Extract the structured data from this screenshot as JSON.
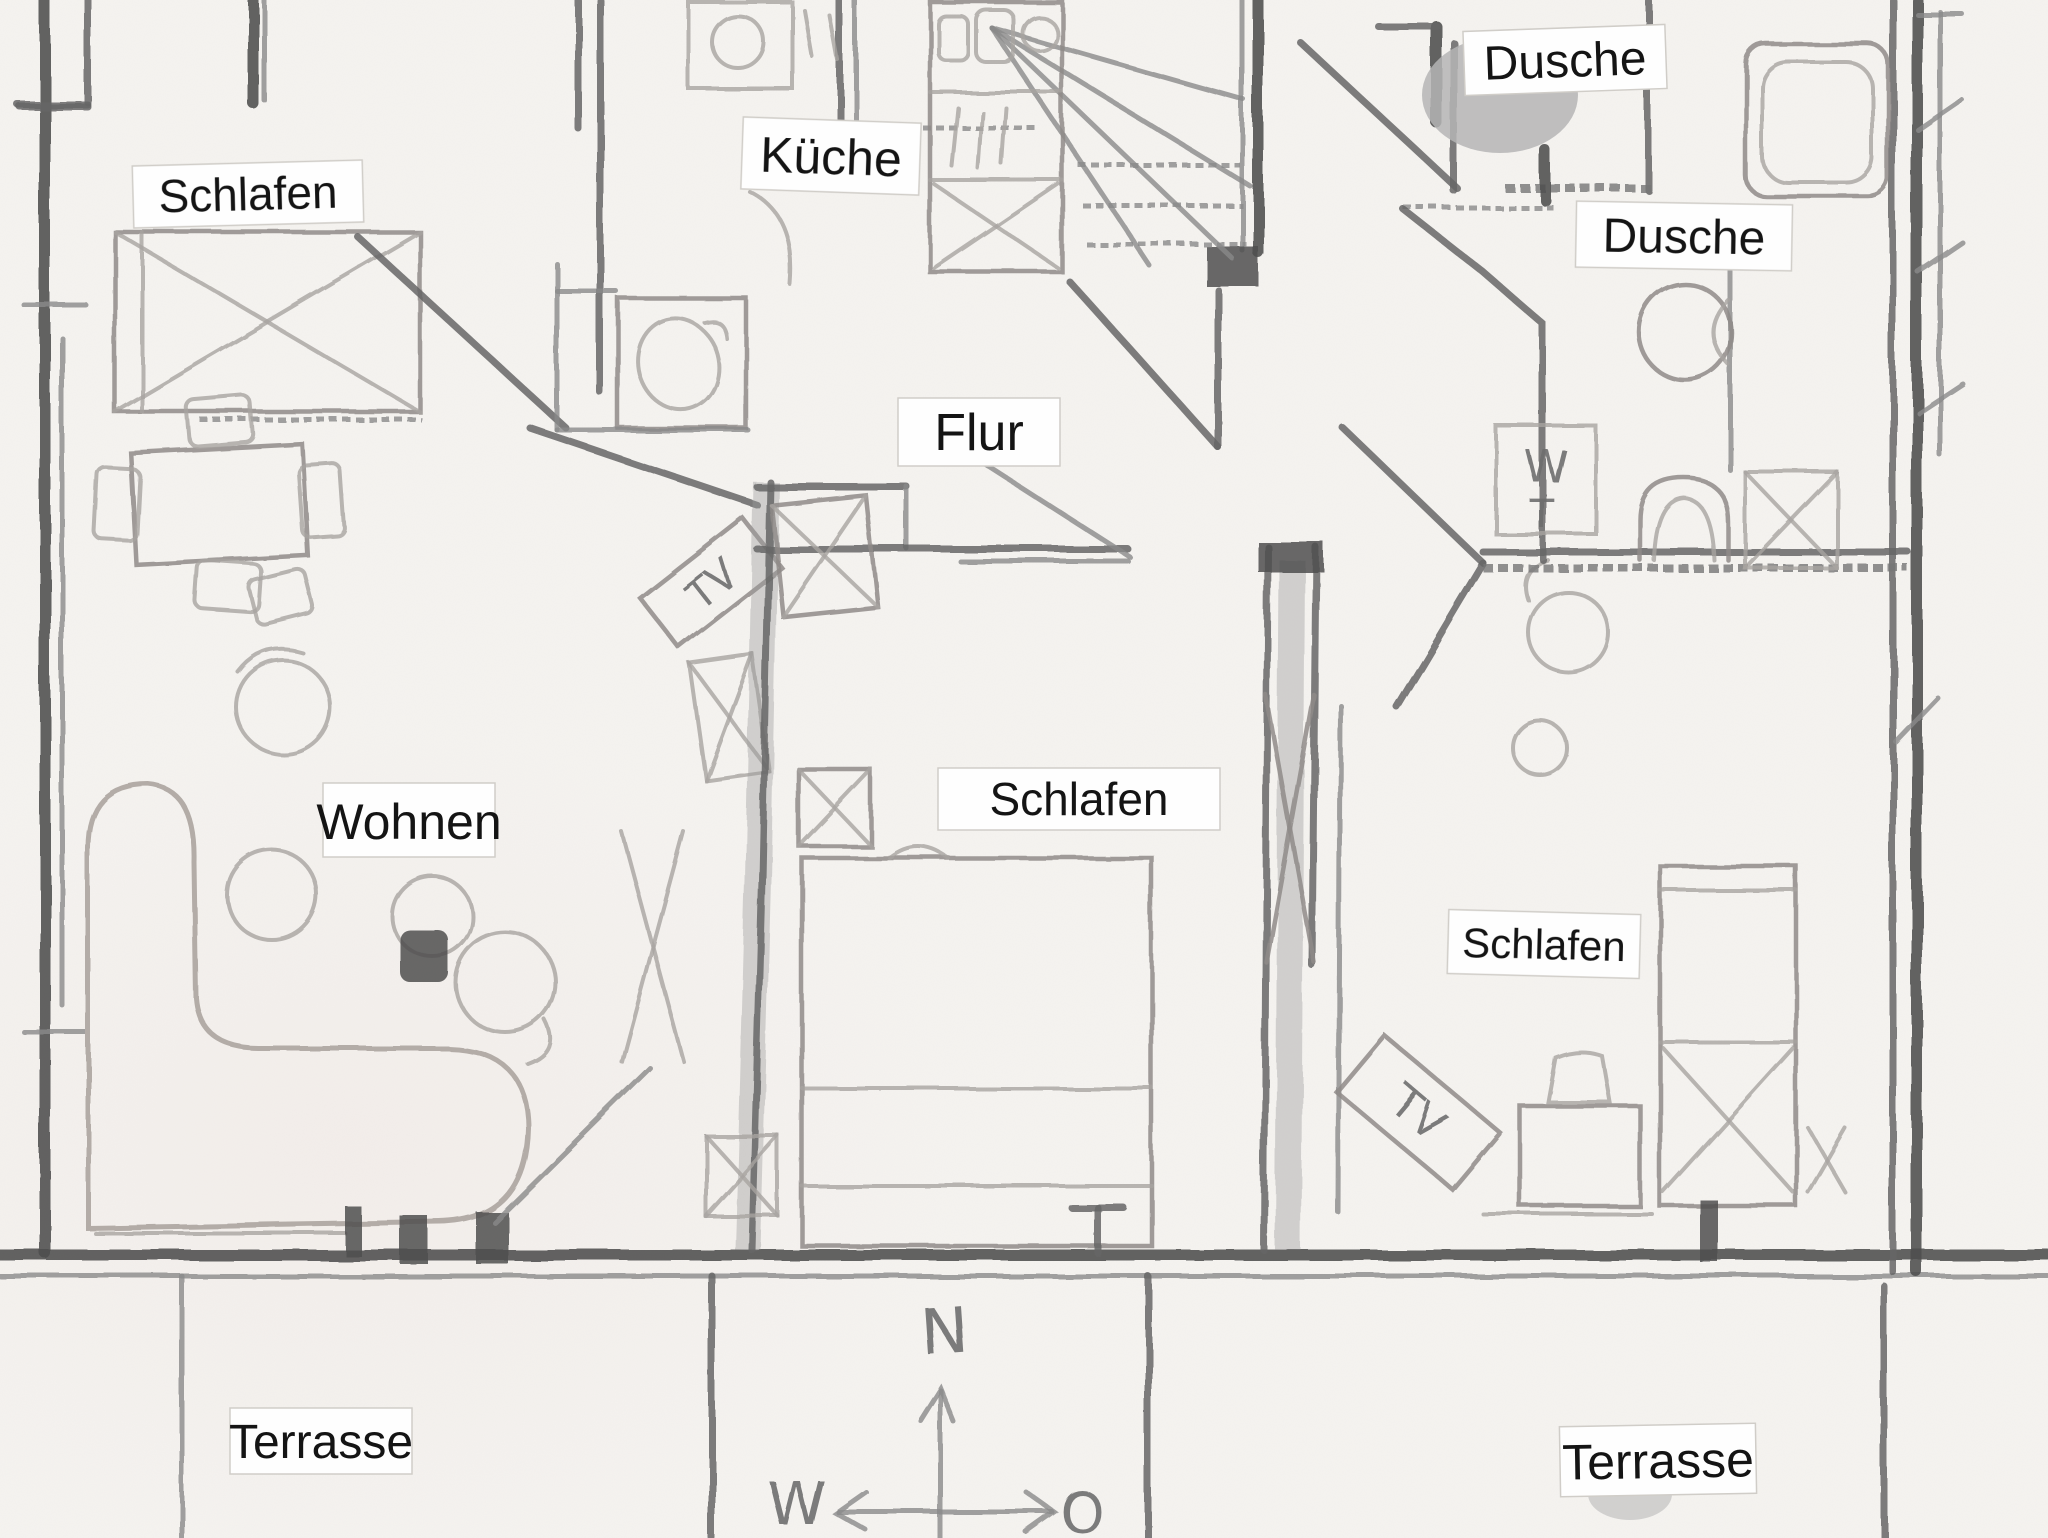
{
  "document": {
    "kind": "hand-drawn floor plan sketch (pencil) with printed label strips",
    "language": "de"
  },
  "room_labels": [
    {
      "id": "schlafen-top-left",
      "text": "Schlafen"
    },
    {
      "id": "kueche",
      "text": "Küche"
    },
    {
      "id": "dusche-top",
      "text": "Dusche"
    },
    {
      "id": "dusche-right",
      "text": "Dusche"
    },
    {
      "id": "flur",
      "text": "Flur"
    },
    {
      "id": "schlafen-center",
      "text": "Schlafen"
    },
    {
      "id": "schlafen-right",
      "text": "Schlafen"
    },
    {
      "id": "wohnen",
      "text": "Wohnen"
    },
    {
      "id": "terrasse-left",
      "text": "Terrasse"
    },
    {
      "id": "terrasse-right",
      "text": "Terrasse"
    }
  ],
  "annotations": {
    "tv_living": "TV",
    "tv_bedroom": "TV",
    "washstand_w": "W",
    "washstand_t": "T"
  },
  "compass": {
    "north": "N",
    "west": "W",
    "east": "O"
  },
  "palette": {
    "paper": "#f5f3f0",
    "pencil_dark": "#4f4f4f",
    "pencil": "#6a6a6a",
    "pencil_light": "#8f8b88",
    "label_bg": "#fefefe",
    "label_text": "#141414",
    "shade_gray": "#b5b5b5"
  }
}
